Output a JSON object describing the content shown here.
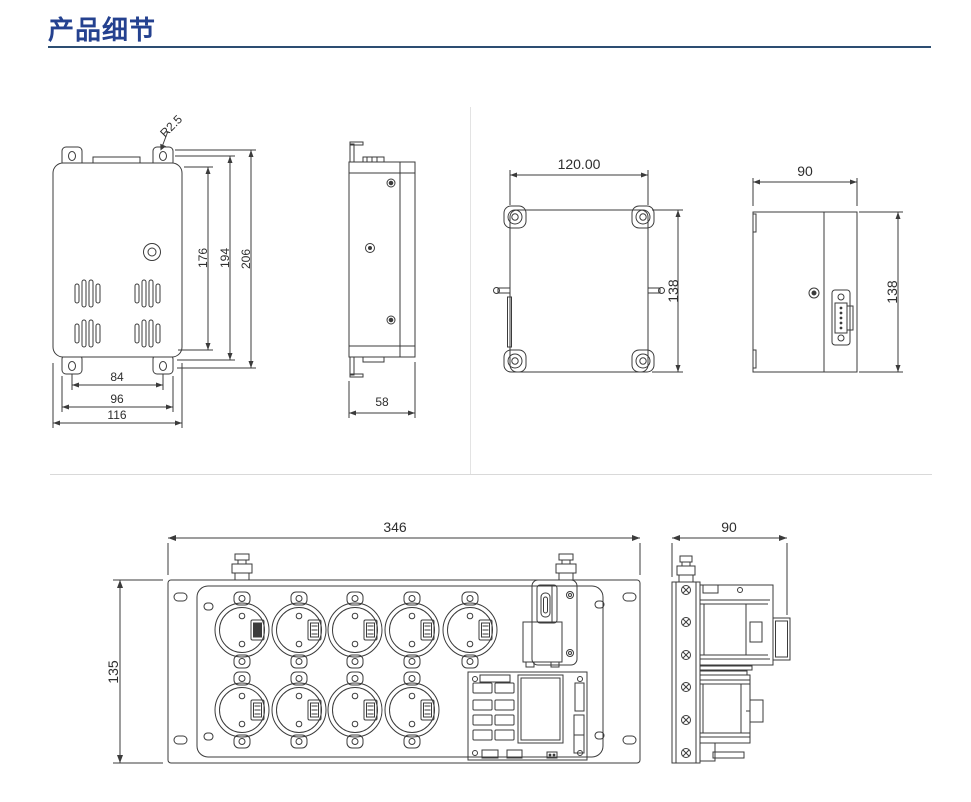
{
  "page_title": "产品细节",
  "colors": {
    "title_text": "#24418f",
    "title_rule": "#2d4e72",
    "drawing_line": "#3b3b3b",
    "divider": "#d9d9d9"
  },
  "views": {
    "front": {
      "radius": "R2.5",
      "height_inner": "176",
      "height_mid": "194",
      "height_outer": "206",
      "width_inner": "84",
      "width_mid": "96",
      "width_outer": "116"
    },
    "side": {
      "depth": "58"
    },
    "rear": {
      "width": "120.00",
      "height": "138"
    },
    "rear_side": {
      "width": "90",
      "height": "138"
    },
    "panel_front": {
      "width": "346",
      "height": "135"
    },
    "panel_side": {
      "width": "90"
    }
  }
}
